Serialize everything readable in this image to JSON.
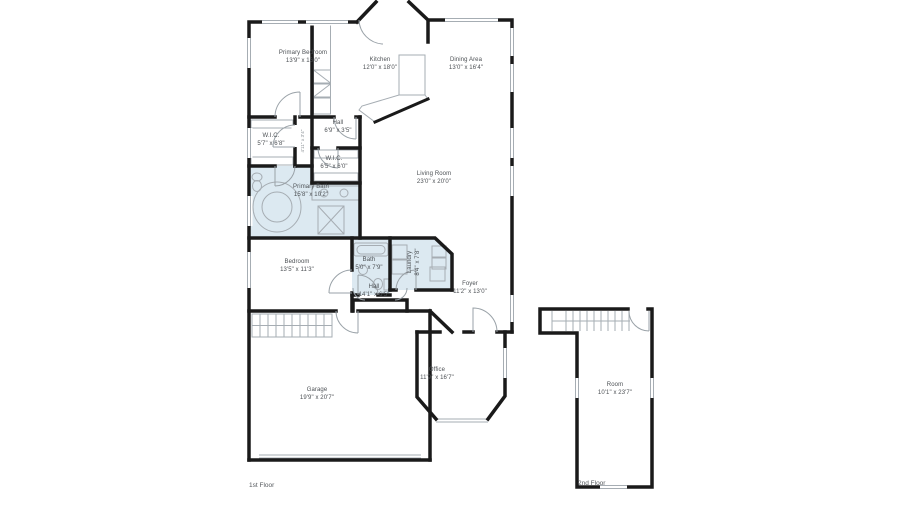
{
  "document": {
    "type": "floor-plan",
    "floors": [
      {
        "caption": "1st Floor"
      },
      {
        "caption": "2nd Floor"
      }
    ]
  },
  "colors": {
    "wall": "#1a1a1a",
    "fixture_line": "#a6adb3",
    "bath_fill": "#dce9f1",
    "label_text": "#4c5054",
    "background": "#ffffff"
  },
  "rooms": [
    {
      "id": "primary-bedroom",
      "name": "Primary Bedroom",
      "dims": "13'9\" x 16'0\""
    },
    {
      "id": "kitchen",
      "name": "Kitchen",
      "dims": "12'0\" x 18'0\""
    },
    {
      "id": "dining-area",
      "name": "Dining Area",
      "dims": "13'0\" x 16'4\""
    },
    {
      "id": "hall-upper",
      "name": "Hall",
      "dims": "6'9\" x 3'5\""
    },
    {
      "id": "wic-left",
      "name": "W.I.C.",
      "dims": "5'7\" x 6'8\""
    },
    {
      "id": "wic-right",
      "name": "W.I.C.",
      "dims": "6'5\" x 6'0\""
    },
    {
      "id": "primary-bath",
      "name": "Primary Bath",
      "dims": "15'8\" x 10'2\""
    },
    {
      "id": "living-room",
      "name": "Living Room",
      "dims": "23'0\" x 20'0\""
    },
    {
      "id": "bedroom",
      "name": "Bedroom",
      "dims": "13'5\" x 11'3\""
    },
    {
      "id": "bath",
      "name": "Bath",
      "dims": "5'0\" x 7'9\""
    },
    {
      "id": "laundry",
      "name": "Laundry",
      "dims": "8'4\" x 7'8\""
    },
    {
      "id": "closet",
      "name": "",
      "dims": "4'11\" x 3'4\""
    },
    {
      "id": "hall-lower",
      "name": "Hall",
      "dims": "14'1\" x 6'5\""
    },
    {
      "id": "foyer",
      "name": "Foyer",
      "dims": "11'2\" x 13'0\""
    },
    {
      "id": "office",
      "name": "Office",
      "dims": "11'9\" x 16'7\""
    },
    {
      "id": "garage",
      "name": "Garage",
      "dims": "19'9\" x 20'7\""
    },
    {
      "id": "room",
      "name": "Room",
      "dims": "10'1\" x 23'7\""
    }
  ]
}
